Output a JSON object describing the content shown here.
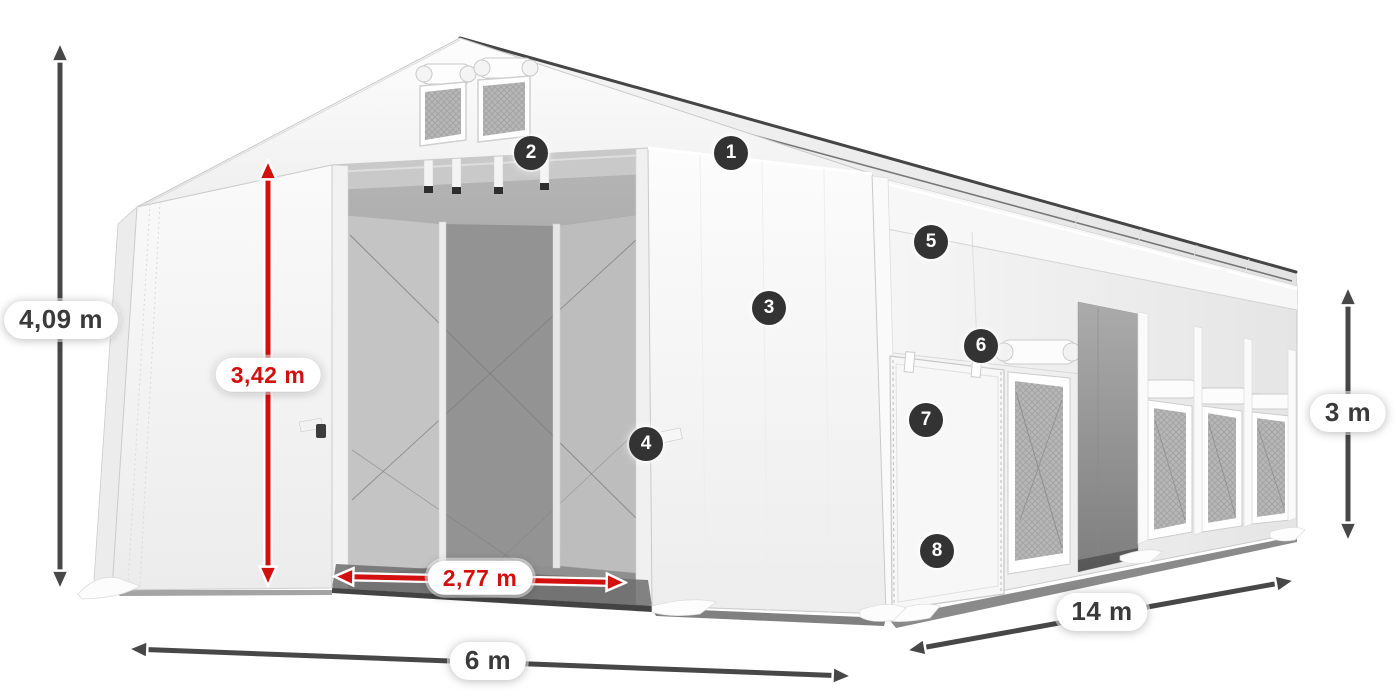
{
  "colors": {
    "page_bg": "#ffffff",
    "accent_red": "#d2100f",
    "arrow_dark": "#474747",
    "badge_bg": "#333333",
    "badge_text": "#ffffff",
    "label_bg": "#ffffff",
    "label_dark_text": "#3a3a3a",
    "tent_white": "#f7f7f7",
    "interior_gray": "#9a9a9a",
    "mesh_gray": "#b5b5b5"
  },
  "dimensions": [
    {
      "id": "total-height",
      "label": "4,09 m",
      "color": "dark"
    },
    {
      "id": "door-height",
      "label": "3,42 m",
      "color": "red"
    },
    {
      "id": "door-width",
      "label": "2,77 m",
      "color": "red"
    },
    {
      "id": "width",
      "label": "6 m",
      "color": "dark"
    },
    {
      "id": "length",
      "label": "14 m",
      "color": "dark"
    },
    {
      "id": "side-height",
      "label": "3 m",
      "color": "dark"
    }
  ],
  "callouts": [
    {
      "number": "1"
    },
    {
      "number": "2"
    },
    {
      "number": "3"
    },
    {
      "number": "4"
    },
    {
      "number": "5"
    },
    {
      "number": "6"
    },
    {
      "number": "7"
    },
    {
      "number": "8"
    }
  ]
}
